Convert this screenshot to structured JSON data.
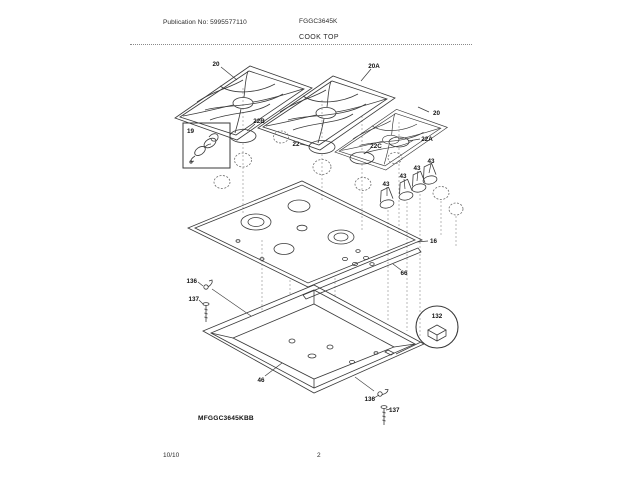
{
  "page": {
    "header": {
      "publication_no": "Publication No: 5995577110",
      "model": "FGGC3645K",
      "section_title": "COOK TOP"
    },
    "footer": {
      "revision_date": "10/10",
      "page_number": "2"
    }
  },
  "diagram": {
    "model_label": "MFGGC3645KBB",
    "callouts": [
      {
        "label": "20"
      },
      {
        "label": "20A"
      },
      {
        "label": "20"
      },
      {
        "label": "22B"
      },
      {
        "label": "19"
      },
      {
        "label": "22"
      },
      {
        "label": "22C"
      },
      {
        "label": "22A"
      },
      {
        "label": "43"
      },
      {
        "label": "43"
      },
      {
        "label": "43"
      },
      {
        "label": "43"
      },
      {
        "label": "16"
      },
      {
        "label": "66"
      },
      {
        "label": "136"
      },
      {
        "label": "137"
      },
      {
        "label": "132"
      },
      {
        "label": "46"
      },
      {
        "label": "136"
      },
      {
        "label": "137"
      }
    ]
  }
}
